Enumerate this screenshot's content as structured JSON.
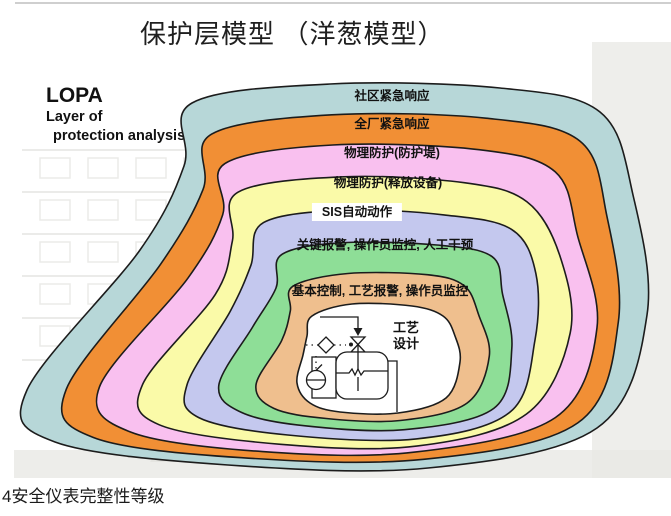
{
  "slide": {
    "title": "保护层模型 （洋葱模型）",
    "caption": "4安全仪表完整性等级",
    "lopa": {
      "acronym": "LOPA",
      "line1": "Layer of",
      "line2": "protection analysis"
    }
  },
  "diagram": {
    "type": "onion-protection-layers",
    "outline_color": "#1c1c1c",
    "layers": [
      {
        "label": "社区紧急响应",
        "color": "#b7d7d8"
      },
      {
        "label": "全厂紧急响应",
        "color": "#f18f35"
      },
      {
        "label": "物理防护(防护堤)",
        "color": "#f9c0ef"
      },
      {
        "label": "物理防护(释放设备)",
        "color": "#fafaa8"
      },
      {
        "label": "SIS自动动作",
        "color": "#c4c8ee"
      },
      {
        "label": "关键报警, 操作员监控, 人工干预",
        "color": "#8ede97"
      },
      {
        "label": "基本控制, 工艺报警, 操作员监控",
        "color": "#efbf8e"
      }
    ],
    "center": {
      "label_line1": "工艺",
      "label_line2": "设计",
      "color": "#ffffff",
      "sketch": "process-vessel-with-valve-and-instruments"
    },
    "background_watermark": "faded-building-photo"
  }
}
